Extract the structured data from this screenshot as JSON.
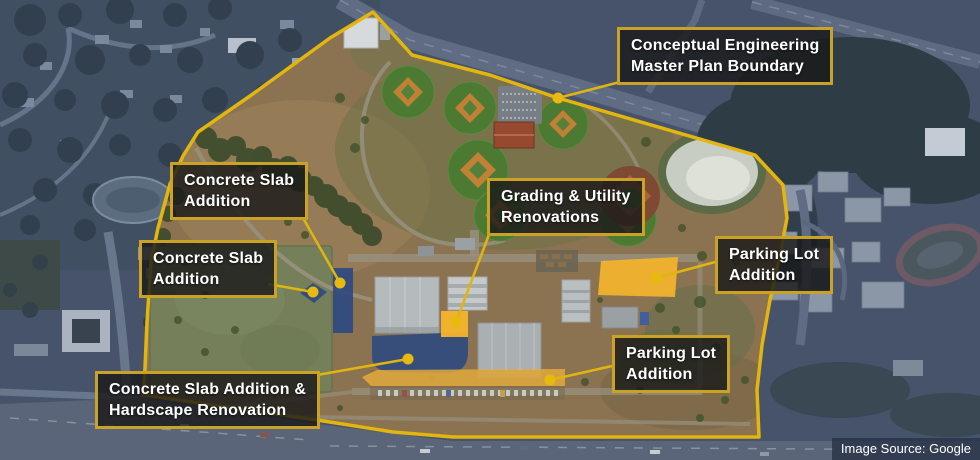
{
  "map": {
    "title": "Conceptual Engineering Master Plan aerial map",
    "callouts": {
      "boundary": {
        "line1": "Conceptual Engineering",
        "line2": "Master Plan Boundary"
      },
      "slab_upper": {
        "line1": "Concrete Slab",
        "line2": "Addition"
      },
      "slab_lower": {
        "line1": "Concrete Slab",
        "line2": "Addition"
      },
      "grading": {
        "line1": "Grading & Utility",
        "line2": "Renovations"
      },
      "parking_right": {
        "line1": "Parking Lot",
        "line2": "Addition"
      },
      "parking_bottom": {
        "line1": "Parking Lot",
        "line2": "Addition"
      },
      "hardscape": {
        "line1": "Concrete Slab Addition &",
        "line2": "Hardscape Renovation"
      }
    },
    "attribution": "Image Source: Google",
    "colors": {
      "boundary_yellow": "#e3b50f",
      "callout_border": "#c9a227",
      "callout_background": "rgba(26,26,26,0.82)",
      "callout_text": "#ffffff",
      "overlay_blue": "#2e4a80",
      "overlay_yellow": "#f4b42c",
      "outside_tint": "#46536a",
      "inside_terrain": "#8b7251"
    }
  }
}
